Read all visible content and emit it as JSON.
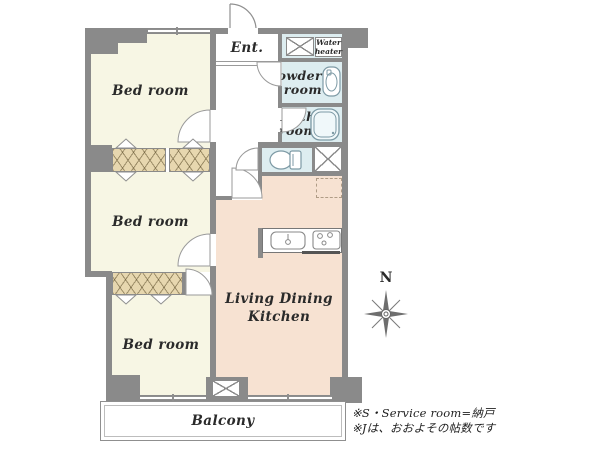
{
  "plan": {
    "rooms": {
      "bed1": {
        "label": "Bed room"
      },
      "bed2": {
        "label": "Bed room"
      },
      "bed3": {
        "label": "Bed room"
      },
      "entry": {
        "label": "Ent."
      },
      "water_heater": {
        "label_line1": "Water",
        "label_line2": "heater"
      },
      "powder": {
        "label_line1": "Powder",
        "label_line2": "room"
      },
      "bath": {
        "label_line1": "Bath",
        "label_line2": "room"
      },
      "ldk": {
        "label_line1": "Living Dining",
        "label_line2": "Kitchen"
      },
      "balcony": {
        "label": "Balcony"
      }
    },
    "compass": {
      "label": "N"
    },
    "notes": {
      "line1": "※S・Service room=納戸",
      "line2": "※Jは、おおよその帖数です"
    },
    "colors": {
      "wall": "#8a8a8a",
      "bedroom_fill": "#f7f6e4",
      "ldk_fill": "#f7e2d2",
      "wet_area_fill": "#ddedf0",
      "closet_fill": "#e7d7af",
      "text": "#2a2a2a"
    }
  }
}
